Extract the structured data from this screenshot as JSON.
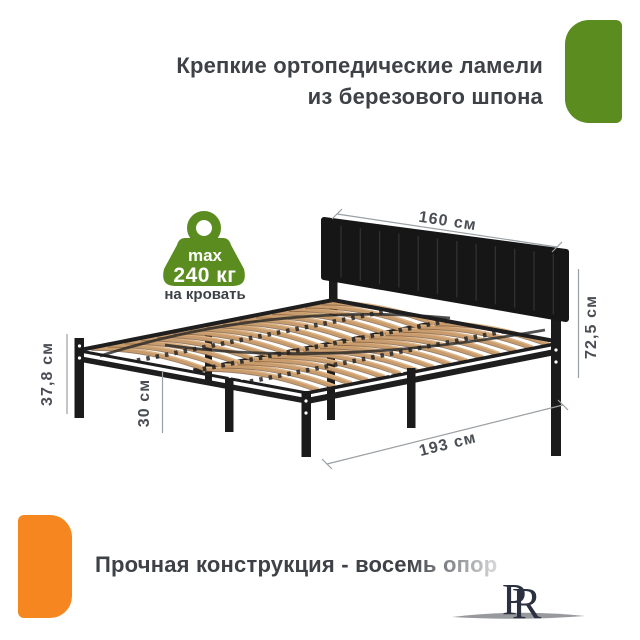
{
  "header": {
    "line1": "Крепкие ортопедические ламели",
    "line2": "из березового шпона"
  },
  "badge": {
    "max_label": "max",
    "weight": "240 кг",
    "caption": "на кровать"
  },
  "dims": {
    "width": "160 см",
    "total_height": "72,5 см",
    "frame_height": "37,8 см",
    "leg_height": "30 см",
    "length": "193 см"
  },
  "footer": {
    "title": "Прочная конструкция - восемь опор"
  },
  "logo": {
    "letter_p": "P",
    "letter_r": "R"
  },
  "colors": {
    "accent_green": "#5b8c1f",
    "accent_orange": "#f6861f",
    "heading_text": "#3e4247",
    "dimension_text": "#4a4e54",
    "wood_slat": "#c89c6c",
    "frame_black": "#1e1e1e"
  }
}
